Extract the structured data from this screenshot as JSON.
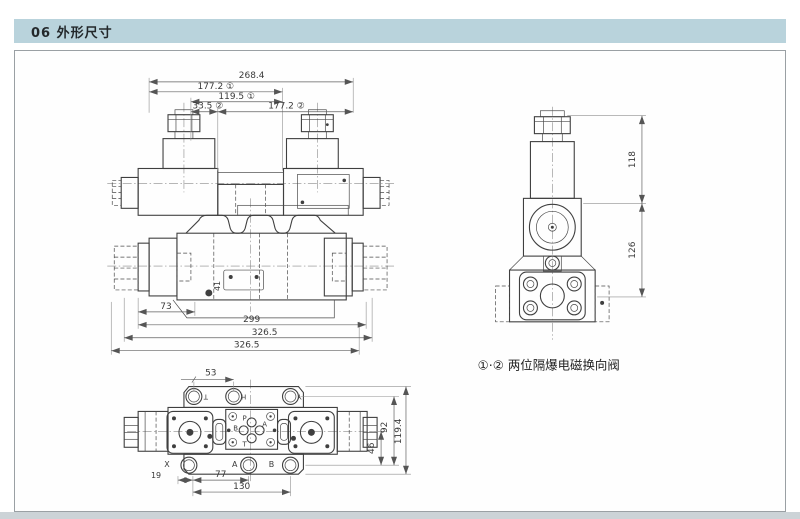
{
  "page": {
    "header_title": "06 外形尺寸",
    "caption": "①·② 两位隔爆电磁换向阀"
  },
  "front_view": {
    "dim_overall": "268.4",
    "dim_177_1": "177.2 ①",
    "dim_119_5": "119.5 ①",
    "dim_33_5": "33.5 ②",
    "dim_177_2": "177.2 ②",
    "dim_73": "73",
    "dim_299": "299",
    "dim_326_upper": "326.5",
    "dim_326_lower": "326.5",
    "marker_41": "41"
  },
  "side_view": {
    "dim_118": "118",
    "dim_126": "126"
  },
  "top_view": {
    "dim_53": "53",
    "dim_46": "46",
    "dim_92": "92",
    "dim_119_4": "119.4",
    "dim_19": "19",
    "dim_77": "77",
    "dim_130": "130",
    "port_top_t": "T",
    "port_top_h": "H",
    "port_top_y": "Y",
    "port_bottom_x": "X",
    "port_bottom_a": "A",
    "port_bottom_b": "B",
    "port_p": "P",
    "port_a": "A",
    "port_b": "B",
    "port_t": "T"
  },
  "colors": {
    "header_bg": "#b9d3dc",
    "outline": "#3f3f3f",
    "dimension": "#606060"
  }
}
